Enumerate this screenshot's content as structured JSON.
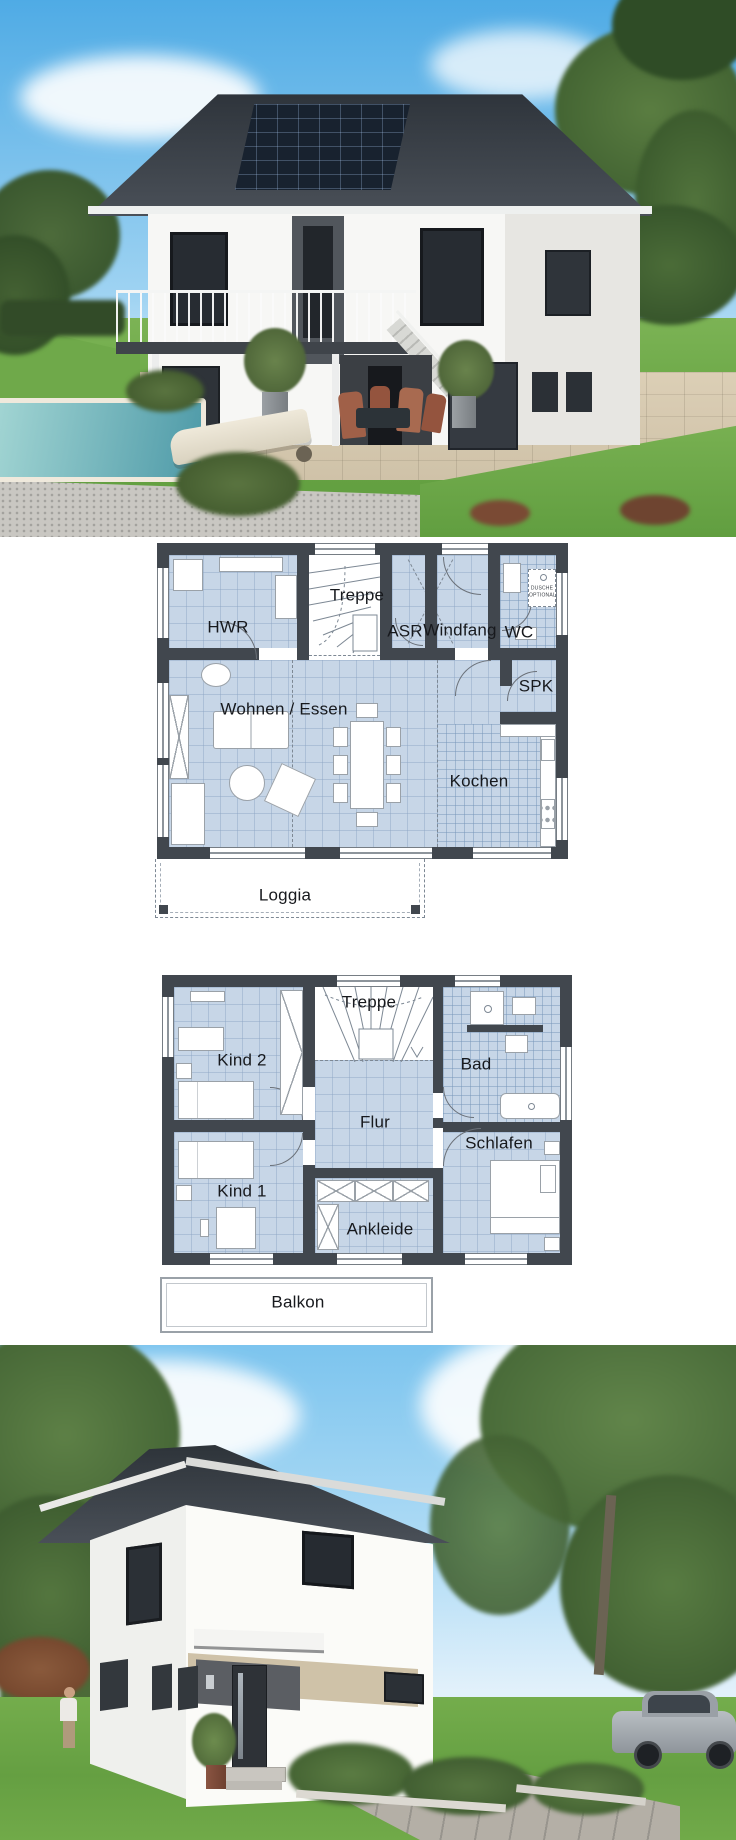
{
  "colors": {
    "plan_wall": "#41474e",
    "plan_room_fill": "#c7d6e7",
    "plan_tile_line": "#9db4cc",
    "plan_background": "#ffffff",
    "sky_blue": "#6fbceb",
    "grass_green": "#6fa94a",
    "roof_charcoal": "#3a4046",
    "facade_white": "#f6f6f4",
    "solar_panel_navy": "#18222f",
    "pool_teal": "#65a8b0",
    "accent_beige": "#cfc2a8",
    "door_anthracite": "#2e3237"
  },
  "plan1": {
    "rooms": {
      "hwr": "HWR",
      "treppe": "Treppe",
      "asr": "ASR",
      "windfang": "Windfang",
      "wc": "WC",
      "spk": "SPK",
      "wohnen_essen": "Wohnen / Essen",
      "kochen": "Kochen"
    },
    "notes": {
      "dusche_optional": "DUSCHE OPTIONAL"
    },
    "outdoor": {
      "loggia": "Loggia"
    }
  },
  "plan2": {
    "rooms": {
      "treppe": "Treppe",
      "kind2": "Kind 2",
      "bad": "Bad",
      "flur": "Flur",
      "schlafen": "Schlafen",
      "kind1": "Kind 1",
      "ankleide": "Ankleide"
    },
    "outdoor": {
      "balkon": "Balkon"
    }
  }
}
